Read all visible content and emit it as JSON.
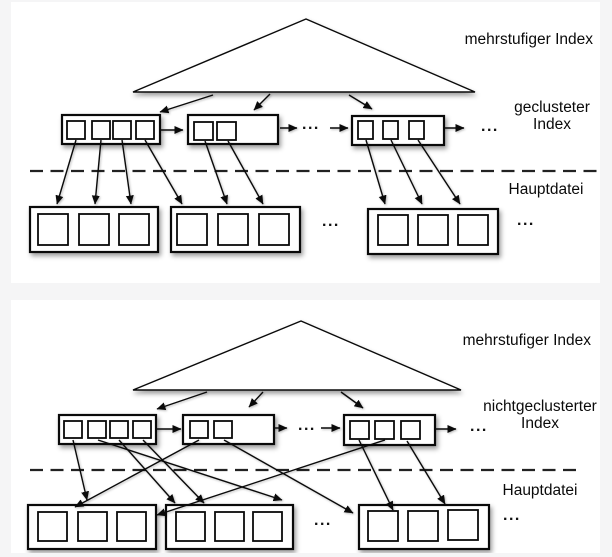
{
  "page": {
    "bg": "#f5f5f6",
    "panel_bg": "#ffffff",
    "ink": "#0a0a0a"
  },
  "diagram1": {
    "multilevel_label": "mehrstufiger Index",
    "index_label_line1": "geclusteter",
    "index_label_line2": "Index",
    "file_label": "Hauptdatei",
    "ellipsis": "...",
    "geometry": {
      "triangle": [
        [
          295,
          17
        ],
        [
          122,
          90
        ],
        [
          464,
          90
        ]
      ],
      "tri_arrows": [
        [
          202,
          93,
          149,
          110
        ],
        [
          259,
          92,
          243,
          108
        ],
        [
          338,
          93,
          361,
          107
        ]
      ],
      "index_boxes": [
        {
          "x": 51,
          "y": 113,
          "w": 98,
          "h": 29,
          "cw": 18,
          "ch": 18,
          "cells": [
            [
              56,
              119
            ],
            [
              81,
              119
            ],
            [
              102,
              119
            ],
            [
              125,
              119
            ]
          ]
        },
        {
          "x": 177,
          "y": 113,
          "w": 90,
          "h": 29,
          "cw": 19,
          "ch": 18,
          "cells": [
            [
              183,
              120
            ],
            [
              206,
              120
            ]
          ]
        },
        {
          "x": 341,
          "y": 114,
          "w": 92,
          "h": 29,
          "cw": 15,
          "ch": 18,
          "cells": [
            [
              347,
              119
            ],
            [
              372,
              119
            ],
            [
              398,
              119
            ]
          ]
        }
      ],
      "flow_arrows": [
        [
          149,
          128,
          172,
          128
        ],
        [
          269,
          126,
          286,
          126
        ],
        [
          319,
          126,
          337,
          126
        ],
        [
          433,
          126,
          453,
          126
        ]
      ],
      "divider": [
        19,
        169,
        586,
        169
      ],
      "data_boxes": [
        {
          "x": 19,
          "y": 205,
          "w": 128,
          "h": 45,
          "cw": 30,
          "ch": 31,
          "cells": [
            [
              27,
              212
            ],
            [
              68,
              212
            ],
            [
              108,
              212
            ]
          ]
        },
        {
          "x": 160,
          "y": 205,
          "w": 129,
          "h": 45,
          "cw": 30,
          "ch": 31,
          "cells": [
            [
              166,
              212
            ],
            [
              207,
              212
            ],
            [
              248,
              212
            ]
          ]
        },
        {
          "x": 357,
          "y": 207,
          "w": 130,
          "h": 45,
          "cw": 30,
          "ch": 30,
          "cells": [
            [
              367,
              213
            ],
            [
              407,
              213
            ],
            [
              447,
              213
            ]
          ]
        }
      ],
      "pointer_arrows": [
        [
          65,
          138,
          46,
          202
        ],
        [
          90,
          138,
          84,
          202
        ],
        [
          111,
          138,
          120,
          202
        ],
        [
          134,
          138,
          171,
          202
        ],
        [
          194,
          139,
          216,
          202
        ],
        [
          217,
          139,
          252,
          202
        ],
        [
          355,
          138,
          374,
          202
        ],
        [
          380,
          138,
          411,
          202
        ],
        [
          407,
          138,
          449,
          202
        ]
      ]
    }
  },
  "diagram2": {
    "multilevel_label": "mehrstufiger Index",
    "index_label_line1": "nichtgeclusterter",
    "index_label_line2": "Index",
    "file_label": "Hauptdatei",
    "ellipsis": "...",
    "geometry": {
      "triangle": [
        [
          290,
          21
        ],
        [
          122,
          90
        ],
        [
          450,
          90
        ]
      ],
      "tri_arrows": [
        [
          196,
          92,
          146,
          109
        ],
        [
          252,
          92,
          238,
          107
        ],
        [
          330,
          92,
          352,
          108
        ]
      ],
      "index_boxes": [
        {
          "x": 48,
          "y": 115,
          "w": 97,
          "h": 29,
          "cw": 18,
          "ch": 17,
          "cells": [
            [
              53,
              121
            ],
            [
              77,
              121
            ],
            [
              99,
              121
            ],
            [
              122,
              121
            ]
          ]
        },
        {
          "x": 172,
          "y": 115,
          "w": 91,
          "h": 29,
          "cw": 18,
          "ch": 17,
          "cells": [
            [
              179,
              121
            ],
            [
              203,
              121
            ]
          ]
        },
        {
          "x": 333,
          "y": 115,
          "w": 91,
          "h": 30,
          "cw": 19,
          "ch": 18,
          "cells": [
            [
              339,
              121
            ],
            [
              364,
              121
            ],
            [
              390,
              121
            ]
          ]
        }
      ],
      "flow_arrows": [
        [
          145,
          129,
          170,
          129
        ],
        [
          263,
          128,
          276,
          128
        ],
        [
          310,
          128,
          329,
          128
        ],
        [
          424,
          129,
          445,
          129
        ]
      ],
      "divider": [
        19,
        170,
        572,
        170
      ],
      "data_boxes": [
        {
          "x": 17,
          "y": 205,
          "w": 128,
          "h": 44,
          "cw": 29,
          "ch": 29,
          "cells": [
            [
              27,
              212
            ],
            [
              67,
              212
            ],
            [
              106,
              212
            ]
          ]
        },
        {
          "x": 155,
          "y": 205,
          "w": 127,
          "h": 44,
          "cw": 29,
          "ch": 29,
          "cells": [
            [
              165,
              212
            ],
            [
              204,
              212
            ],
            [
              242,
              212
            ]
          ]
        },
        {
          "x": 348,
          "y": 205,
          "w": 130,
          "h": 44,
          "cw": 30,
          "ch": 30,
          "cells": [
            [
              357,
              211
            ],
            [
              397,
              211
            ],
            [
              437,
              210
            ]
          ]
        }
      ],
      "pointer_arrows": [
        [
          62,
          140,
          76,
          200
        ],
        [
          87,
          140,
          271,
          200
        ],
        [
          108,
          140,
          164,
          203
        ],
        [
          132,
          140,
          193,
          203
        ],
        [
          188,
          140,
          64,
          207
        ],
        [
          213,
          140,
          342,
          213
        ],
        [
          348,
          140,
          382,
          210
        ],
        [
          374,
          140,
          146,
          215
        ],
        [
          396,
          141,
          434,
          204
        ]
      ]
    }
  }
}
